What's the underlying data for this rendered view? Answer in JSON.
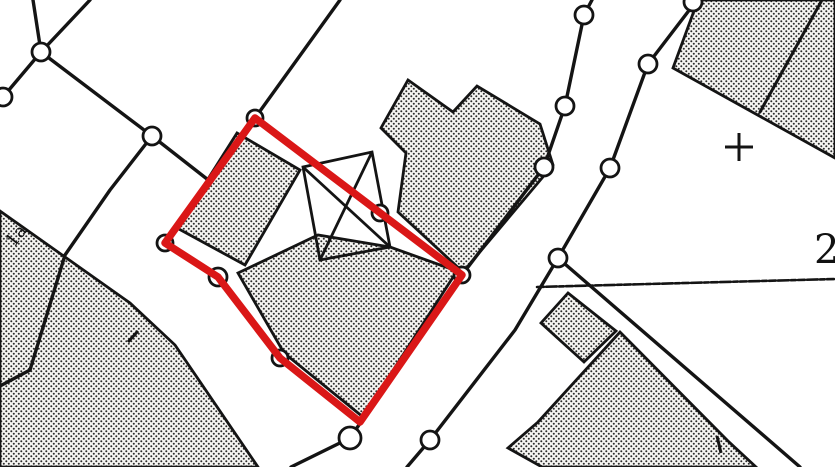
{
  "meta": {
    "title": "Cadastral map extract with highlighted parcel",
    "background_color": "#ffffff",
    "ink_color": "#141414",
    "highlight_color": "#da1717",
    "stipple_dot_color": "#2b2b2b",
    "stipple_bg_color": "#f6f5f2",
    "width": 835,
    "height": 467
  },
  "labels": [
    {
      "name": "map-label-1a",
      "text": "1a",
      "x": 14,
      "y": 248,
      "rotation": -52,
      "size": 18
    },
    {
      "name": "map-label-2",
      "text": "2",
      "x": 814,
      "y": 263,
      "rotation": 0,
      "size": 40
    }
  ],
  "plus_marker": {
    "x": 739,
    "y": 147,
    "arm": 14,
    "width": 3
  },
  "red_parcel": {
    "stroke_width": 7.5,
    "points": [
      [
        255,
        118
      ],
      [
        462,
        275
      ],
      [
        360,
        422
      ],
      [
        280,
        358
      ],
      [
        218,
        277
      ],
      [
        165,
        243
      ]
    ]
  },
  "buildings": [
    {
      "name": "building-top-right",
      "points": [
        [
          698,
          0
        ],
        [
          673,
          68
        ],
        [
          835,
          158
        ],
        [
          835,
          0
        ]
      ]
    },
    {
      "name": "building-main-north",
      "points": [
        [
          408,
          80
        ],
        [
          453,
          112
        ],
        [
          477,
          86
        ],
        [
          540,
          124
        ],
        [
          553,
          165
        ],
        [
          463,
          272
        ],
        [
          398,
          212
        ],
        [
          406,
          153
        ],
        [
          381,
          128
        ]
      ]
    },
    {
      "name": "building-left-wing",
      "points": [
        [
          237,
          133
        ],
        [
          300,
          170
        ],
        [
          245,
          265
        ],
        [
          177,
          228
        ]
      ]
    },
    {
      "name": "building-inner-south",
      "points": [
        [
          238,
          273
        ],
        [
          318,
          235
        ],
        [
          390,
          247
        ],
        [
          457,
          271
        ],
        [
          363,
          417
        ],
        [
          284,
          353
        ]
      ]
    },
    {
      "name": "building-bottom-left",
      "points": [
        [
          0,
          211
        ],
        [
          130,
          303
        ],
        [
          175,
          345
        ],
        [
          258,
          467
        ],
        [
          0,
          467
        ]
      ]
    },
    {
      "name": "building-small-east",
      "points": [
        [
          568,
          293
        ],
        [
          616,
          331
        ],
        [
          584,
          362
        ],
        [
          541,
          323
        ]
      ]
    },
    {
      "name": "building-bottom-right",
      "points": [
        [
          538,
          422
        ],
        [
          620,
          332
        ],
        [
          728,
          441
        ],
        [
          756,
          467
        ],
        [
          542,
          467
        ],
        [
          508,
          448
        ]
      ]
    }
  ],
  "cross_structure": {
    "outline": [
      [
        303,
        167
      ],
      [
        372,
        152
      ],
      [
        390,
        247
      ],
      [
        320,
        260
      ]
    ],
    "diagonals": [
      [
        [
          303,
          167
        ],
        [
          390,
          247
        ]
      ],
      [
        [
          372,
          152
        ],
        [
          320,
          260
        ]
      ]
    ],
    "width": 2.8
  },
  "boundary_lines": [
    {
      "name": "boundary-line",
      "width": 3.4,
      "points": [
        [
          33,
          0
        ],
        [
          41,
          52
        ]
      ]
    },
    {
      "name": "boundary-line",
      "width": 3.4,
      "points": [
        [
          90,
          0
        ],
        [
          41,
          52
        ]
      ]
    },
    {
      "name": "boundary-line",
      "width": 3.4,
      "points": [
        [
          41,
          52
        ],
        [
          3,
          97
        ],
        [
          0,
          103
        ]
      ]
    },
    {
      "name": "boundary-line",
      "width": 3.4,
      "points": [
        [
          41,
          52
        ],
        [
          152,
          136
        ],
        [
          207,
          179
        ]
      ]
    },
    {
      "name": "boundary-line",
      "width": 3.4,
      "points": [
        [
          152,
          136
        ],
        [
          110,
          190
        ],
        [
          65,
          255
        ],
        [
          30,
          370
        ],
        [
          0,
          386
        ]
      ]
    },
    {
      "name": "boundary-line",
      "width": 3.4,
      "points": [
        [
          340,
          0
        ],
        [
          255,
          118
        ]
      ]
    },
    {
      "name": "boundary-line",
      "width": 3.4,
      "points": [
        [
          255,
          118
        ],
        [
          380,
          213
        ],
        [
          462,
          275
        ]
      ]
    },
    {
      "name": "boundary-line",
      "width": 3.4,
      "points": [
        [
          462,
          275
        ],
        [
          350,
          438
        ],
        [
          291,
          467
        ]
      ]
    },
    {
      "name": "boundary-line",
      "width": 3.4,
      "points": [
        [
          592,
          0
        ],
        [
          584,
          15
        ],
        [
          565,
          106
        ],
        [
          544,
          167
        ],
        [
          462,
          275
        ]
      ]
    },
    {
      "name": "boundary-line",
      "width": 3.4,
      "points": [
        [
          697,
          0
        ],
        [
          648,
          64
        ],
        [
          610,
          168
        ],
        [
          558,
          258
        ]
      ]
    },
    {
      "name": "boundary-line",
      "width": 3.4,
      "points": [
        [
          558,
          258
        ],
        [
          515,
          330
        ],
        [
          430,
          440
        ],
        [
          407,
          467
        ]
      ]
    },
    {
      "name": "boundary-line",
      "width": 3.4,
      "points": [
        [
          558,
          258
        ],
        [
          800,
          467
        ]
      ]
    },
    {
      "name": "boundary-line",
      "width": 2.6,
      "dash": "7 2 11 2 5 2",
      "points": [
        [
          537,
          287
        ],
        [
          835,
          279
        ]
      ]
    },
    {
      "name": "parcel-divider-line",
      "width": 3.0,
      "points": [
        [
          822,
          0
        ],
        [
          760,
          112
        ]
      ]
    }
  ],
  "ticks": [
    {
      "name": "tick-mark",
      "points": [
        [
          717,
          436
        ],
        [
          721,
          453
        ]
      ]
    },
    {
      "name": "tick-mark",
      "points": [
        [
          128,
          342
        ],
        [
          138,
          331
        ]
      ]
    }
  ],
  "markers": [
    {
      "x": 41,
      "y": 52,
      "r": 9
    },
    {
      "x": 3,
      "y": 97,
      "r": 9
    },
    {
      "x": 152,
      "y": 136,
      "r": 9
    },
    {
      "x": 255,
      "y": 118,
      "r": 8
    },
    {
      "x": 165,
      "y": 243,
      "r": 8
    },
    {
      "x": 218,
      "y": 277,
      "r": 9
    },
    {
      "x": 280,
      "y": 358,
      "r": 8
    },
    {
      "x": 380,
      "y": 213,
      "r": 8
    },
    {
      "x": 462,
      "y": 275,
      "r": 8
    },
    {
      "x": 350,
      "y": 438,
      "r": 11
    },
    {
      "x": 430,
      "y": 440,
      "r": 9
    },
    {
      "x": 584,
      "y": 15,
      "r": 9
    },
    {
      "x": 565,
      "y": 106,
      "r": 9
    },
    {
      "x": 544,
      "y": 167,
      "r": 9
    },
    {
      "x": 648,
      "y": 64,
      "r": 9
    },
    {
      "x": 610,
      "y": 168,
      "r": 9
    },
    {
      "x": 558,
      "y": 258,
      "r": 9
    },
    {
      "x": 693,
      "y": 2,
      "r": 9
    }
  ]
}
